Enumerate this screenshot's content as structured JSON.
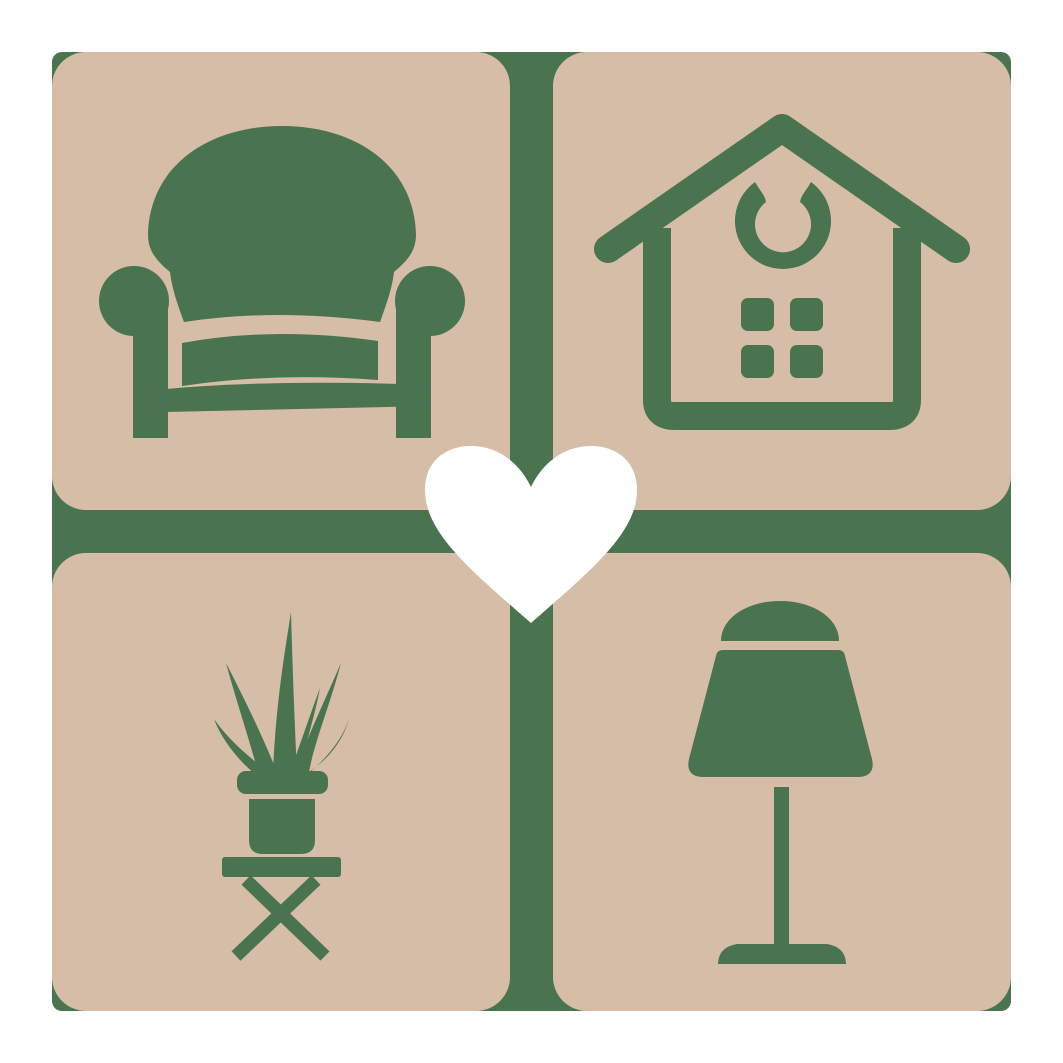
{
  "colors": {
    "page_background": "#ffffff",
    "grid_green": "#4a7350",
    "tile_tan": "#d5bda7",
    "heart_white": "#ffffff"
  },
  "icons": {
    "top_left": "armchair",
    "top_right": "house-with-windows-and-ornament",
    "bottom_left": "potted-plant-on-stool",
    "bottom_right": "table-lamp",
    "center": "heart"
  }
}
